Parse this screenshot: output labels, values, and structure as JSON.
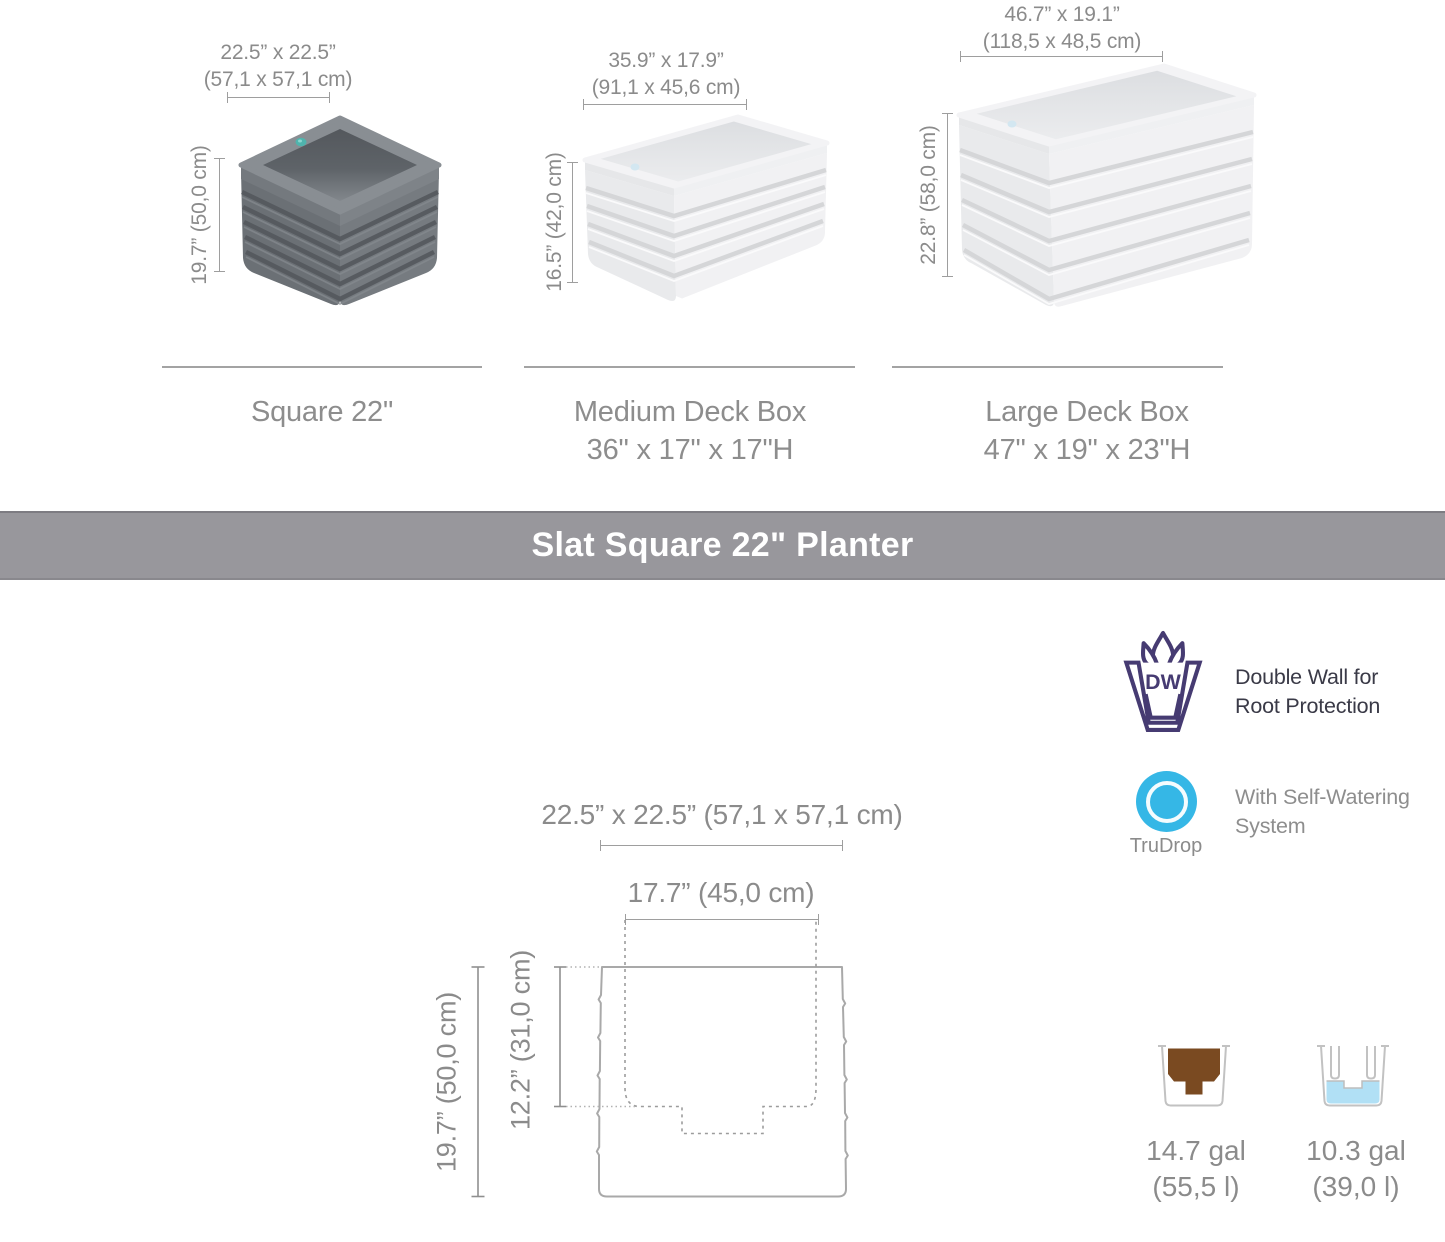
{
  "products": [
    {
      "name_line1": "Square 22\"",
      "name_line2": "",
      "footprint_in": "22.5” x 22.5”",
      "footprint_cm": "(57,1 x 57,1 cm)",
      "height": "19.7” (50,0 cm)"
    },
    {
      "name_line1": "Medium Deck Box",
      "name_line2": "36\" x 17\" x 17\"H",
      "footprint_in": "35.9” x 17.9”",
      "footprint_cm": "(91,1 x 45,6 cm)",
      "height": "16.5” (42,0 cm)"
    },
    {
      "name_line1": "Large Deck Box",
      "name_line2": "47\" x 19\" x 23\"H",
      "footprint_in": "46.7” x 19.1”",
      "footprint_cm": "(118,5 x 48,5 cm)",
      "height": "22.8” (58,0 cm)"
    }
  ],
  "banner": {
    "title": "Slat Square 22\" Planter"
  },
  "cross_section": {
    "outer_footprint": "22.5” x 22.5” (57,1 x 57,1 cm)",
    "inner_opening": "17.7” (45,0 cm)",
    "outer_height": "19.7” (50,0 cm)",
    "inner_depth": "12.2” (31,0 cm)"
  },
  "features": [
    {
      "icon": "double-wall-icon",
      "icon_label": "DW",
      "line1": "Double Wall for",
      "line2": "Root Protection"
    },
    {
      "icon": "trudrop-icon",
      "icon_label": "TruDrop",
      "line1": "With Self-Watering",
      "line2": "System"
    }
  ],
  "capacities": [
    {
      "kind": "soil",
      "amount": "14.7 gal",
      "liters": "(55,5 l)"
    },
    {
      "kind": "water",
      "amount": "10.3 gal",
      "liters": "(39,0 l)"
    }
  ],
  "colors": {
    "banner_bg": "#98979c",
    "text_gray": "#8b8b8b",
    "feature_text_dark": "#3a3a47",
    "dw_purple": "#463b72",
    "trudrop_blue": "#35b7e6",
    "soil_brown": "#7a4a21",
    "water_blue": "#b1e0f5",
    "planter_dark_gray": "#6e7377",
    "planter_light_gray": "#ececee"
  }
}
